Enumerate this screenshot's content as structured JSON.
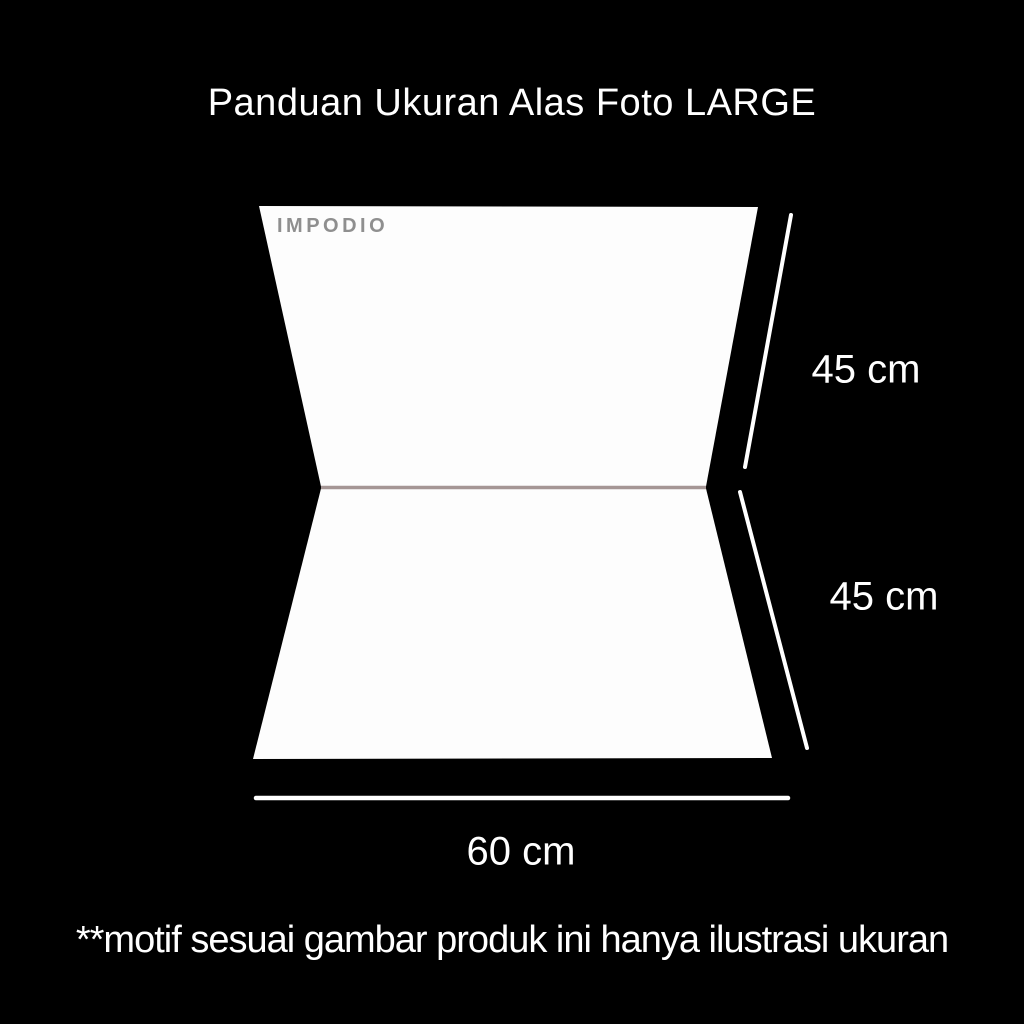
{
  "title": "Panduan Ukuran Alas Foto LARGE",
  "watermark": "IMPODIO",
  "diagram": {
    "product": "Alas Foto (photo backdrop), size LARGE, folded view",
    "back_panel_height_label": "45 cm",
    "floor_panel_depth_label": "45 cm",
    "width_label": "60 cm"
  },
  "footnote": "**motif sesuai gambar produk ini hanya ilustrasi ukuran",
  "colors": {
    "background": "#000000",
    "panel_fill": "#fdfdfd",
    "fold_line": "#a59695",
    "dimension_line": "#ffffff",
    "title_text": "#ffffff",
    "watermark_text": "#8f8f8f"
  }
}
